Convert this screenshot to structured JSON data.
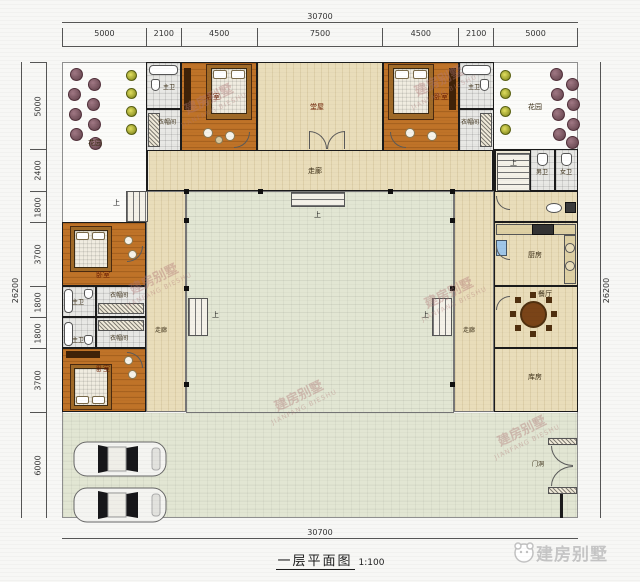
{
  "meta": {
    "title": "一层平面图",
    "scale": "1:100"
  },
  "brand": {
    "name": "建房别墅",
    "name_en": "JIANFANG BIESHU"
  },
  "dims": {
    "top_total": "30700",
    "top_segments": [
      "5000",
      "2100",
      "4500",
      "7500",
      "4500",
      "2100",
      "5000"
    ],
    "left_total": "26200",
    "left_segments": [
      "5000",
      "2400",
      "1800",
      "3700",
      "1800",
      "1800",
      "3700",
      "6000"
    ],
    "right_total": "26200",
    "bottom_total": "30700"
  },
  "rooms": {
    "garden": "花园",
    "bedroom": "卧室",
    "master_bath": "主卫",
    "cloakroom": "衣帽间",
    "hall": "堂屋",
    "corridor": "走廊",
    "toilet_men": "男卫",
    "toilet_women": "女卫",
    "kitchen": "厨房",
    "dining": "餐厅",
    "storage": "库房",
    "gate": "门洞",
    "up": "上"
  },
  "colors": {
    "wood_floor": "#bf7328",
    "tile_floor": "#e9ddba",
    "courtyard": "#e2e6d3",
    "wall": "#1b1b1b"
  }
}
